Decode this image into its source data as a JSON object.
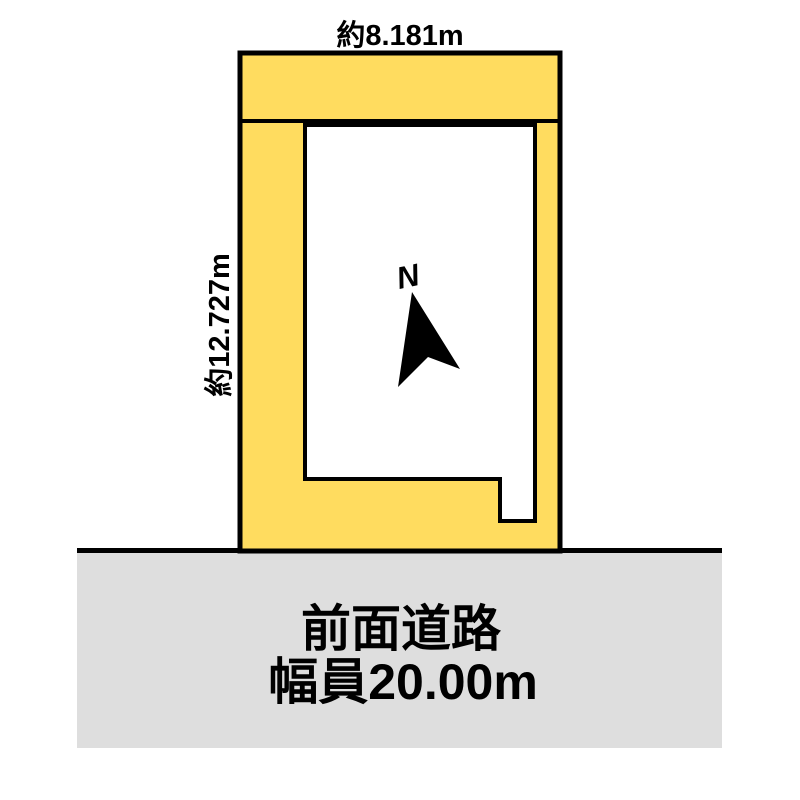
{
  "diagram": {
    "title": "land-plot-site-diagram",
    "labels": {
      "top_dimension": "約8.181m",
      "left_dimension": "約12.727m",
      "north": "N"
    },
    "road": {
      "line1": "前面道路",
      "line2": "幅員20.00m"
    }
  },
  "colors": {
    "background": "#ffffff",
    "plot_fill": "#ffdc5f",
    "inner_fill": "#ffffff",
    "road_fill": "#dedede",
    "outline": "#000000",
    "arrow_fill": "#000000",
    "text": "#000000"
  }
}
